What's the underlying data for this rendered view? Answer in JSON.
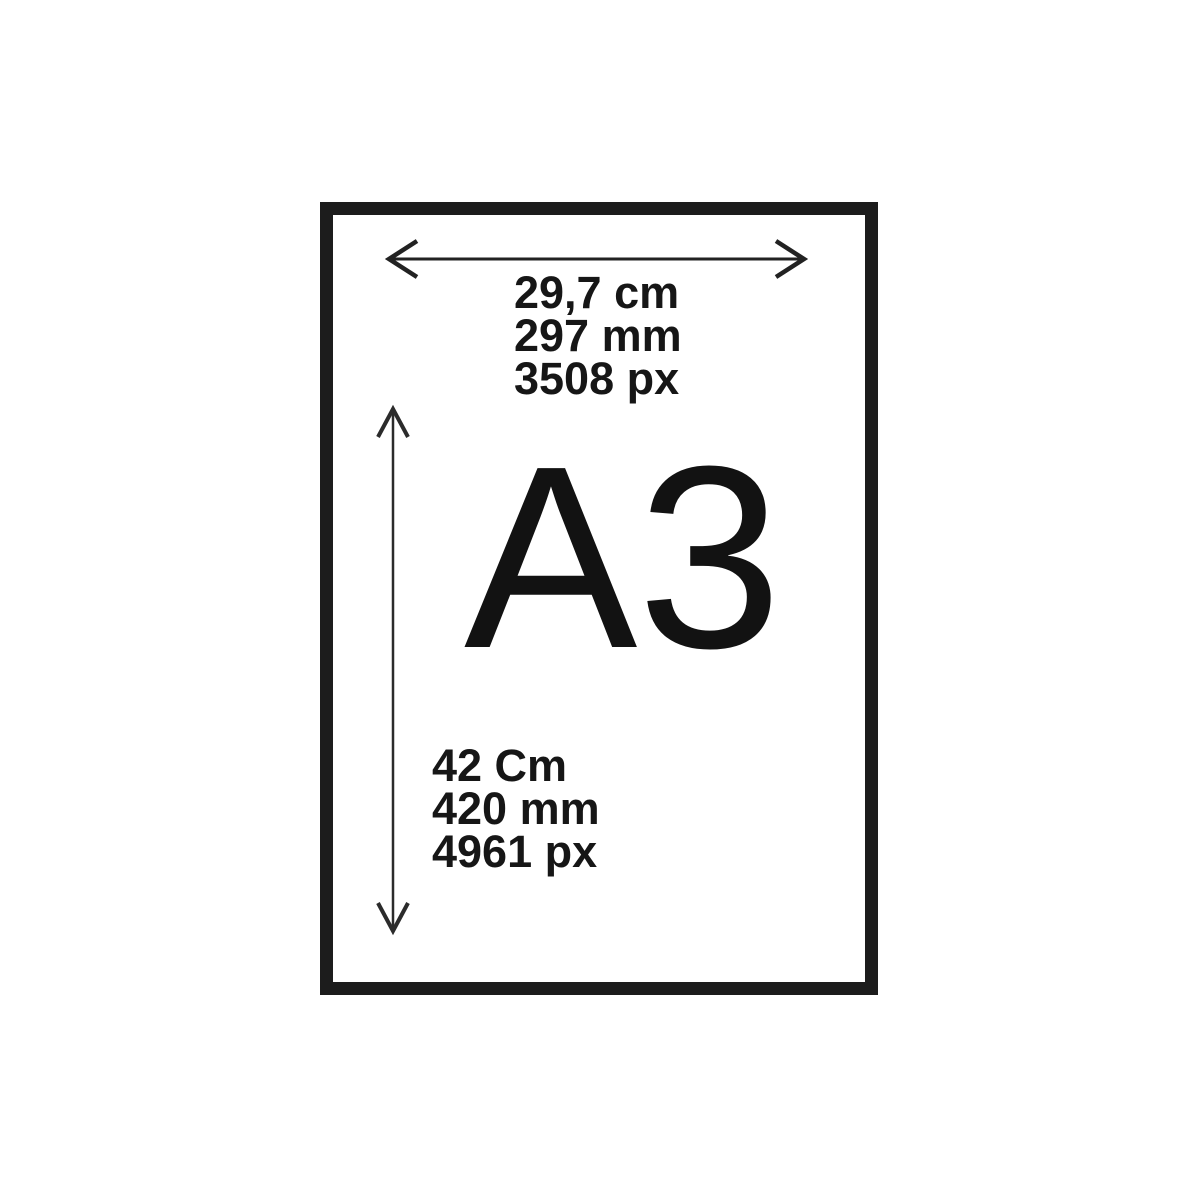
{
  "diagram": {
    "title": "A3",
    "width_dimension": {
      "lines": [
        "29,7 cm",
        "297 mm",
        "3508 px"
      ]
    },
    "height_dimension": {
      "lines": [
        "42 Cm",
        "420 mm",
        "4961 px"
      ]
    }
  },
  "colors": {
    "background": "#ffffff",
    "frame": "#1c1c1c",
    "ink": "#161616"
  },
  "icons": {
    "width_arrow": "horizontal-double-arrow",
    "height_arrow": "vertical-double-arrow"
  }
}
